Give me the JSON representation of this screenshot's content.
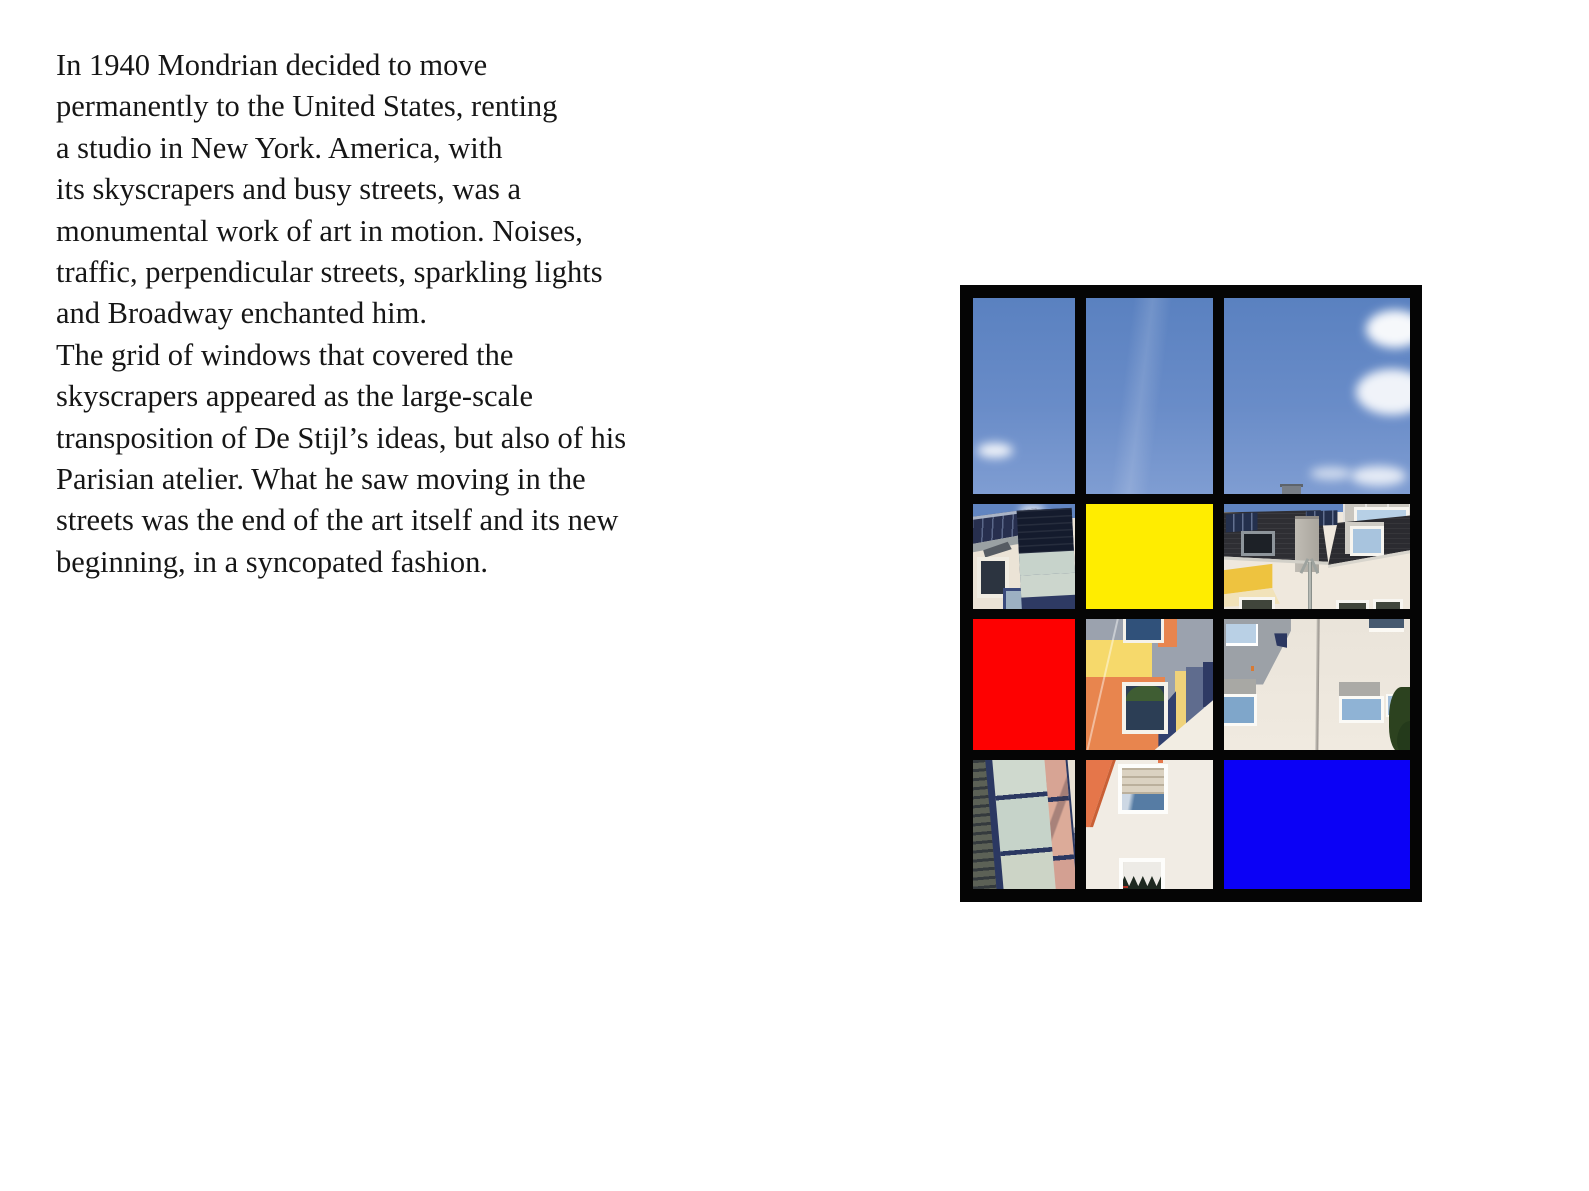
{
  "page": {
    "background_color": "#ffffff",
    "kind": "book-spread-page"
  },
  "article": {
    "text_color": "#161616",
    "lines": [
      "In 1940 Mondrian decided to move",
      "permanently to the United States, renting",
      "a studio in New York. America, with",
      "its skyscrapers and busy streets, was a",
      "monumental work of art in motion. Noises,",
      "traffic, perpendicular streets, sparkling lights",
      "and Broadway enchanted him.",
      "The grid of windows that covered the",
      "skyscrapers appeared as the large-scale",
      "transposition of De Stijl’s ideas, but also of his",
      "Parisian atelier. What he saw moving in the",
      "streets was the end of the art itself and its new",
      "beginning, in a syncopated fashion."
    ]
  },
  "artwork": {
    "description": "Mondrian-style window grid collage: 3 columns x 4 rows framed in black; photos of sky and building facades mixed with solid primary-color blocks",
    "frame_color": "#050505",
    "solid_colors": {
      "red": "#fe0101",
      "yellow": "#ffed00",
      "blue": "#0b01f6"
    },
    "photo_palette": {
      "sky_blue": "#6287c4",
      "cream_wall": "#efe8dd",
      "dark_roof": "#2e2e33",
      "facade_orange": "#e8854e",
      "glass_navy": "#2b3862"
    },
    "cells": [
      {
        "row": 1,
        "col": 1,
        "name": "sky-photo-left",
        "type": "photo",
        "subject": "blue sky with small cloud"
      },
      {
        "row": 1,
        "col": 2,
        "name": "sky-photo-middle",
        "type": "photo",
        "subject": "clear blue sky"
      },
      {
        "row": 1,
        "col": 3,
        "name": "sky-photo-right",
        "type": "photo",
        "subject": "blue sky, clouds right, chimney at bottom"
      },
      {
        "row": 2,
        "col": 1,
        "name": "rooftop-solar-tower-photo",
        "type": "photo",
        "subject": "roof with solar panels and glass stair tower"
      },
      {
        "row": 2,
        "col": 2,
        "name": "yellow-block",
        "type": "solid",
        "color": "#ffed00"
      },
      {
        "row": 2,
        "col": 3,
        "name": "rooftops-streetlamp-photo",
        "type": "photo",
        "subject": "tiled roofs, solar panels, dormer, street lamp, yellow wall patch"
      },
      {
        "row": 3,
        "col": 1,
        "name": "red-block",
        "type": "solid",
        "color": "#fe0101"
      },
      {
        "row": 3,
        "col": 2,
        "name": "colorful-facade-photo",
        "type": "photo",
        "subject": "postmodern facade with orange, yellow, gray fields and windows"
      },
      {
        "row": 3,
        "col": 3,
        "name": "white-facade-photo",
        "type": "photo",
        "subject": "white facade, windows, downpipe, tree at right"
      },
      {
        "row": 4,
        "col": 1,
        "name": "glass-facade-photo",
        "type": "photo",
        "subject": "glass curtain wall with navy mullions and salmon panes"
      },
      {
        "row": 4,
        "col": 2,
        "name": "wall-windows-photo",
        "type": "photo",
        "subject": "white wall, orange corner, shuttered window, lace-curtain window"
      },
      {
        "row": 4,
        "col": 3,
        "name": "blue-block",
        "type": "solid",
        "color": "#0b01f6"
      }
    ]
  }
}
